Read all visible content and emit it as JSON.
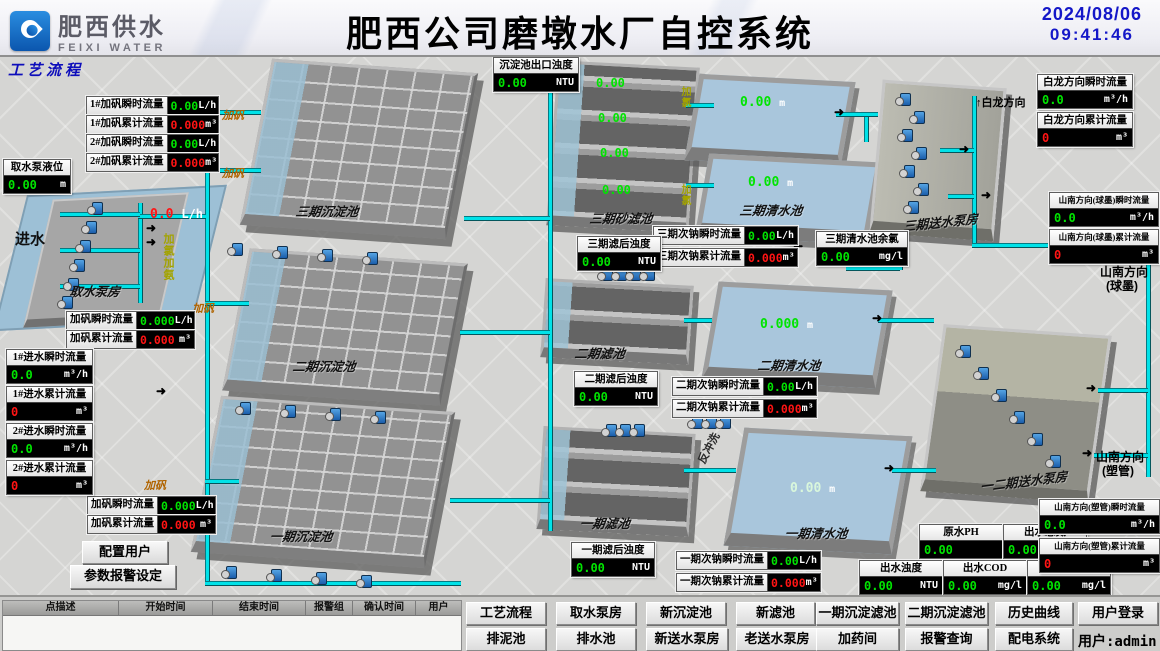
{
  "header": {
    "logo_cn": "肥西供水",
    "logo_en": "FEIXI WATER",
    "title": "肥西公司磨墩水厂自控系统",
    "date": "2024/08/06",
    "time": "09:41:46"
  },
  "page_label": "工艺流程",
  "icons": {
    "flow_arrow": "➜",
    "up_arrow": "↑",
    "dose_arrow": "↓"
  },
  "colors": {
    "value_green": "#00e400",
    "value_red": "#ff1414",
    "pipe_cyan": "#00e2e8",
    "time_blue": "#1417c8"
  },
  "boxes": {
    "b1": {
      "label": "1#加矾瞬时流量",
      "value": "0.00",
      "unit": "L/h"
    },
    "b2": {
      "label": "1#加矾累计流量",
      "value": "0.000",
      "unit": "m³"
    },
    "b3": {
      "label": "2#加矾瞬时流量",
      "value": "0.00",
      "unit": "L/h"
    },
    "b4": {
      "label": "2#加矾累计流量",
      "value": "0.000",
      "unit": "m³"
    },
    "b5": {
      "label": "加矾瞬时流量",
      "value": "0.000",
      "unit": "L/h"
    },
    "b6": {
      "label": "加矾累计流量",
      "value": "0.000",
      "unit": "m³"
    },
    "b7": {
      "label": "加矾瞬时流量",
      "value": "0.000",
      "unit": "L/h"
    },
    "b8": {
      "label": "加矾累计流量",
      "value": "0.000",
      "unit": "m³"
    },
    "b9": {
      "label": "取水泵液位",
      "value": "0.00",
      "unit": "m"
    },
    "b10": {
      "label": "1#进水瞬时流量",
      "value": "0.0",
      "unit": "m³/h"
    },
    "b11": {
      "label": "1#进水累计流量",
      "value": "0",
      "unit": "m³"
    },
    "b12": {
      "label": "2#进水瞬时流量",
      "value": "0.0",
      "unit": "m³/h"
    },
    "b13": {
      "label": "2#进水累计流量",
      "value": "0",
      "unit": "m³"
    },
    "b14": {
      "label": "沉淀池出口浊度",
      "value": "0.00",
      "unit": "NTU"
    },
    "b15": {
      "label": "三期滤后浊度",
      "value": "0.00",
      "unit": "NTU"
    },
    "b16": {
      "label": "三期次钠瞬时流量",
      "value": "0.00",
      "unit": "L/h"
    },
    "b17": {
      "label": "三期次钠累计流量",
      "value": "0.000",
      "unit": "m³"
    },
    "b18": {
      "label": "三期清水池余氯",
      "value": "0.00",
      "unit": "mg/l"
    },
    "b19": {
      "label": "白龙方向瞬时流量",
      "value": "0.0",
      "unit": "m³/h"
    },
    "b20": {
      "label": "白龙方向累计流量",
      "value": "0",
      "unit": "m³"
    },
    "b21": {
      "label": "山南方向(球墨)瞬时流量",
      "value": "0.0",
      "unit": "m³/h"
    },
    "b22": {
      "label": "山南方向(球墨)累计流量",
      "value": "0",
      "unit": "m³"
    },
    "b23": {
      "label": "二期滤后浊度",
      "value": "0.00",
      "unit": "NTU"
    },
    "b24": {
      "label": "二期次钠瞬时流量",
      "value": "0.00",
      "unit": "L/h"
    },
    "b25": {
      "label": "二期次钠累计流量",
      "value": "0.000",
      "unit": "m³"
    },
    "b26": {
      "label": "一期滤后浊度",
      "value": "0.00",
      "unit": "NTU"
    },
    "b27": {
      "label": "一期次钠瞬时流量",
      "value": "0.00",
      "unit": "L/h"
    },
    "b28": {
      "label": "一期次钠累计流量",
      "value": "0.000",
      "unit": "m³"
    },
    "b29": {
      "label": "原水PH",
      "value": "0.00",
      "unit": ""
    },
    "b30": {
      "label": "出水总氮",
      "value": "0.00",
      "unit": "mg/l"
    },
    "b31": {
      "label": "出水浊度",
      "value": "0.00",
      "unit": "NTU"
    },
    "b32": {
      "label": "出水COD",
      "value": "0.00",
      "unit": "mg/l"
    },
    "b33": {
      "label": "出水余氯",
      "value": "0.00",
      "unit": "mg/l"
    },
    "b34": {
      "label": "山南方向(塑管)瞬时流量",
      "value": "0.0",
      "unit": "m³/h"
    },
    "b35": {
      "label": "山南方向(塑管)累计流量",
      "value": "0",
      "unit": "m³"
    }
  },
  "values": {
    "sand_filter": [
      "0.00",
      "0.00",
      "0.00",
      "0.00"
    ],
    "cw3a": "0.00",
    "cw3b": "0.00",
    "cw2": "0.000",
    "cw1": "0.00",
    "level_unit": "m",
    "intake_flow": "0.0",
    "intake_flow_unit": "L/h"
  },
  "labels": {
    "inlet": "进水",
    "intake_house": "取水泵房",
    "basin3": "三期沉淀池",
    "sand3": "三期砂滤池",
    "clear3": "三期清水池",
    "pump3": "三期送水泵房",
    "basin2": "二期沉淀池",
    "filter2": "二期滤池",
    "clear2": "二期清水池",
    "basin1": "一期沉淀池",
    "filter1": "一期滤池",
    "clear1": "一期清水池",
    "pump12": "一二期送水泵房",
    "dir_bailong": "白龙方向",
    "dir_shannan_qiu": "山南方向",
    "dir_shannan_qiu2": "(球墨)",
    "dir_shannan_su": "山南方向",
    "dir_shannan_su2": "(塑管)",
    "dose_fan": "加矾",
    "dose_cl": "加氯加氨",
    "dose_cl_small": "加氯",
    "backwash": "反冲洗"
  },
  "buttons": {
    "config_user": "配置用户",
    "param_alarm": "参数报警设定"
  },
  "alarm_table": {
    "headers": [
      "点描述",
      "开始时间",
      "结束时间",
      "报警组",
      "确认时间",
      "用户"
    ]
  },
  "nav": {
    "row1": [
      "工艺流程",
      "取水泵房",
      "新沉淀池",
      "新滤池",
      "一期沉淀滤池",
      "二期沉淀滤池",
      "历史曲线",
      "用户登录"
    ],
    "row2": [
      "排泥池",
      "排水池",
      "新送水泵房",
      "老送水泵房",
      "加药间",
      "报警查询",
      "配电系统"
    ],
    "user": "用户:admin"
  }
}
